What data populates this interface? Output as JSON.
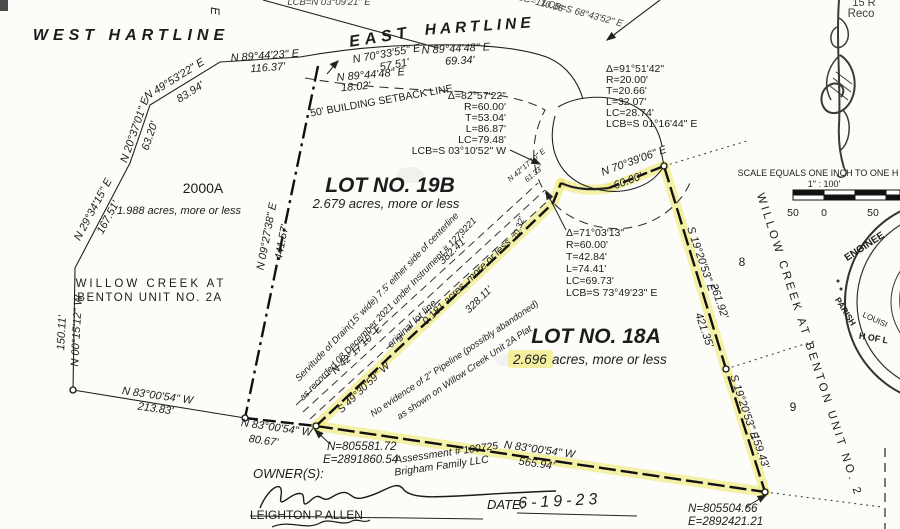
{
  "plat": {
    "colors": {
      "highlight": "#efe871"
    },
    "streets": {
      "west": "WEST HARTLINE",
      "east_1": "EAST",
      "east_2": "HARTLINE",
      "partial_e": "E"
    },
    "corner_partial": {
      "line1": "15 R",
      "line2": "Reco"
    },
    "top_partials": {
      "lcb_n": "LCB=N 03°09'21\" E",
      "lc": "LC=110.06'",
      "lcb_s": "LCB=S 68°43'52\" E"
    },
    "lot_19b": {
      "title": "LOT NO. 19B",
      "area": "2.679 acres, more or less"
    },
    "lot_18a": {
      "title": "LOT NO. 18A",
      "area_value": "2.696",
      "area_suffix": "acres, more or less"
    },
    "lot_2000a": {
      "title": "2000A",
      "area": "1.988 acres, more or less"
    },
    "sliver_area": "0.181 acres, more or less",
    "subdivision_left": {
      "line1": "WILLOW CREEK AT",
      "line2": "BENTON UNIT NO. 2A"
    },
    "subdivision_right": "WILLOW CREEK AT BENTON UNIT NO. 2",
    "lot_numbers": {
      "lot8": "8",
      "lot9": "9"
    },
    "bearings": {
      "n894423": {
        "b": "N 89°44'23\" E",
        "d": "116.37'"
      },
      "n495322": {
        "b": "N 49°53'22\" E",
        "d": "83.94'"
      },
      "n203701": {
        "b": "N 20°37'01\" E",
        "d": "63.20'"
      },
      "n293415": {
        "b": "N 29°34'15\" E",
        "d": "167.51'"
      },
      "n001512": {
        "b": "N 00°15'12\" W",
        "d": "150.11'"
      },
      "n092738": {
        "b": "N 09°27'38\" E",
        "d": "441.57'"
      },
      "n703355": {
        "b": "N 70°33'55\" E",
        "d": "57.51'"
      },
      "n894448a": {
        "b": "N 89°44'48\" E",
        "d": "69.34'"
      },
      "n894448b": {
        "b": "N 89°44'48\" E",
        "d": "18.02'"
      },
      "n703906": {
        "b": "N 70°39'06\" E",
        "d": "60.00'"
      },
      "s192053a": {
        "b": "S 19°20'53\" E",
        "d": "261.92'",
        "d2": "421.35'"
      },
      "s192053b": {
        "b": "S 19°20'53\" E",
        "d": "159.43'"
      },
      "n830054a": {
        "b": "N 83°00'54\" W",
        "d": "213.83'"
      },
      "n830054b": {
        "b": "N 83°00'54\" W",
        "d": "80.67'"
      },
      "n830054c": {
        "b": "N 83°00'54\" W",
        "d": "565.94'"
      },
      "n421710": {
        "b": "N 42°17'10\" E"
      },
      "n421710b": {
        "b": "N 42°17'10\" E",
        "d": "61.33'"
      },
      "s493059": {
        "b": "S 49°30'59\" W",
        "d": "328.11'"
      },
      "d7032": "70.32'",
      "original": {
        "label": "original lot line",
        "d": "382.41'"
      }
    },
    "curves": {
      "c1": {
        "delta": "Δ=82°57'22\"",
        "r": "R=60.00'",
        "t": "T=53.04'",
        "l": "L=86.87'",
        "lc": "LC=79.48'",
        "lcb": "LCB=S 03°10'52\" W"
      },
      "c2": {
        "delta": "Δ=91°51'42\"",
        "r": "R=20.00'",
        "t": "T=20.66'",
        "l": "L=32.07'",
        "lc": "LC=28.74'",
        "lcb": "LCB=S 01°16'44\" E"
      },
      "c3": {
        "delta": "Δ=71°03'13\"",
        "r": "R=60.00'",
        "t": "T=42.84'",
        "l": "L=74.41'",
        "lc": "LC=69.73'",
        "lcb": "LCB=S 73°49'23\" E"
      }
    },
    "notes": {
      "setback": "50' BUILDING SETBACK LINE",
      "servitude1": "Servitude of Drain(15' wide) 7.5' either side of centerline",
      "servitude2": "as recorded 08 December 2021 under Instrument # 1279221",
      "pipeline1": "No evidence of 2\" Pipeline (possibly abandoned)",
      "pipeline2": "as shown on Willow Creek Unit 2A Plat"
    },
    "coordinates": {
      "pt1_n": "N=805581.72",
      "pt1_e": "E=2891860.54",
      "pt2_n": "N=805504.66",
      "pt2_e": "E=2892421.21"
    },
    "assessment": {
      "line1": "Assessment # 100725",
      "line2": "Brigham Family LLC"
    },
    "footer": {
      "owner_label": "OWNER(S):",
      "owner_name": "LEIGHTON P ALLEN",
      "date_label": "DATE:",
      "date_value": "6-19-23"
    },
    "scalebar": {
      "title": "SCALE EQUALS ONE INCH TO ONE H",
      "ratio": "1\" : 100'",
      "left": "50",
      "mid": "0",
      "right": "50"
    },
    "seal": {
      "t1": "ENGINEE",
      "t2": "PARISH",
      "t3": "LOUISI",
      "t4": "H OF L"
    }
  }
}
